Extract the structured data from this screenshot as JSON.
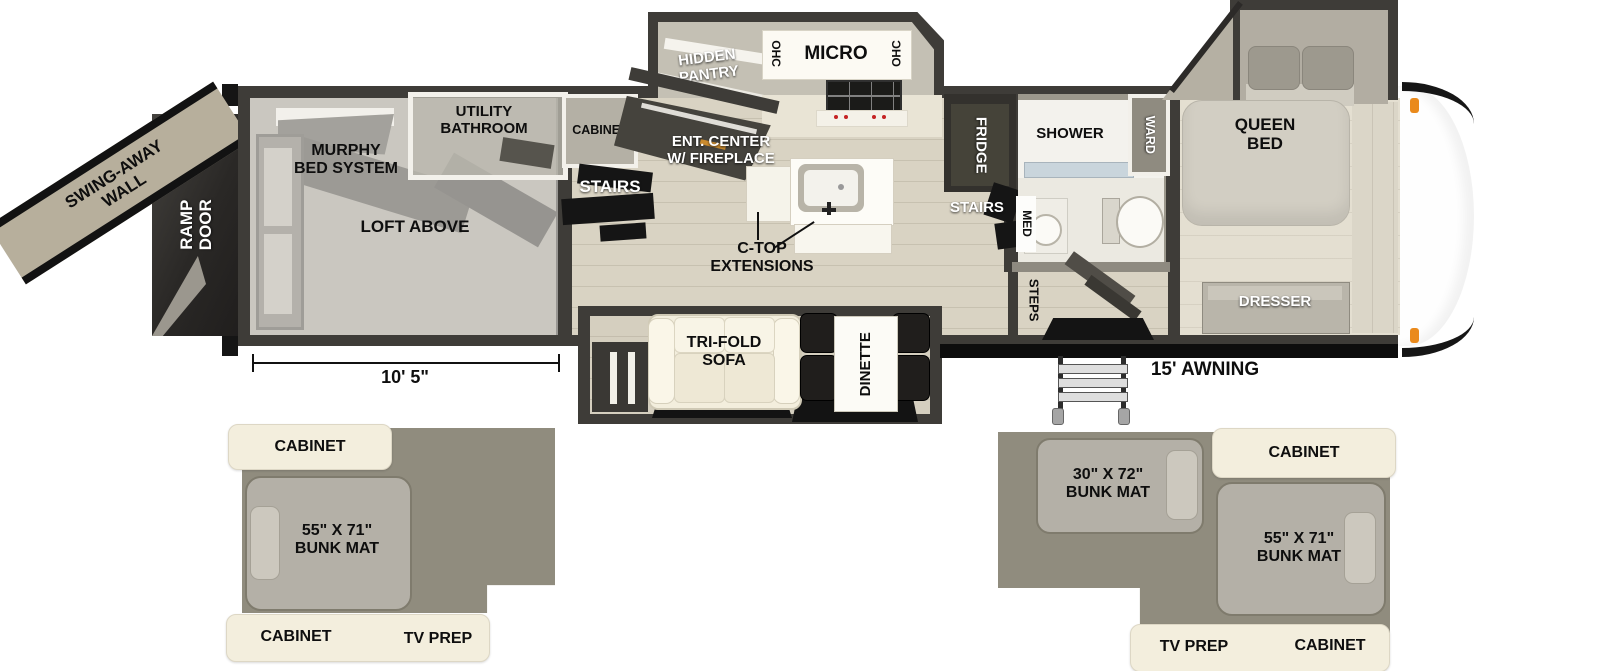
{
  "colors": {
    "wall": "#3e3c38",
    "living_floor": "#d9d3c3",
    "bedroom_floor": "#e4dfd1",
    "garage_floor": "#a39f95",
    "cream_cabinet": "#f3eedd",
    "inset_gray": "#908c7e",
    "bunk_mat": "#b4b0a7",
    "marker_orange": "#ea8a1c",
    "awning_black": "#0d0d0d",
    "burner_red": "#c42222"
  },
  "main": {
    "swing_wall": [
      "SWING-AWAY",
      "WALL"
    ],
    "ramp_door": [
      "RAMP",
      "DOOR"
    ],
    "murphy_bed": [
      "MURPHY",
      "BED SYSTEM"
    ],
    "utility_bath": [
      "UTILITY",
      "BATHROOM"
    ],
    "cabinet": "CABINET",
    "loft": "LOFT ABOVE",
    "hidden_pantry": [
      "HIDDEN",
      "PANTRY"
    ],
    "ohc_left": "OHC",
    "micro": "MICRO",
    "ohc_right": "OHC",
    "ent_center": [
      "ENT. CENTER",
      "W/ FIREPLACE"
    ],
    "stairs_left": "STAIRS",
    "ctop": [
      "C-TOP",
      "EXTENSIONS"
    ],
    "fridge": "FRIDGE",
    "stairs_right": "STAIRS",
    "shower": "SHOWER",
    "med": "MED",
    "ward": "WARD",
    "queen_bed": [
      "QUEEN",
      "BED"
    ],
    "dresser": "DRESSER",
    "steps": "STEPS",
    "sofa": [
      "TRI-FOLD",
      "SOFA"
    ],
    "dinette": "DINETTE",
    "dim_garage": "10' 5\"",
    "awning": "15' AWNING"
  },
  "loft_left": {
    "cabinet_top": "CABINET",
    "bunk": [
      "55\" X 71\"",
      "BUNK MAT"
    ],
    "cabinet_bottom": "CABINET",
    "tv_prep": "TV PREP"
  },
  "loft_right": {
    "bunk_small": [
      "30\" X 72\"",
      "BUNK MAT"
    ],
    "cabinet_top": "CABINET",
    "bunk_large": [
      "55\" X 71\"",
      "BUNK MAT"
    ],
    "tv_prep": "TV PREP",
    "cabinet_bottom": "CABINET"
  }
}
